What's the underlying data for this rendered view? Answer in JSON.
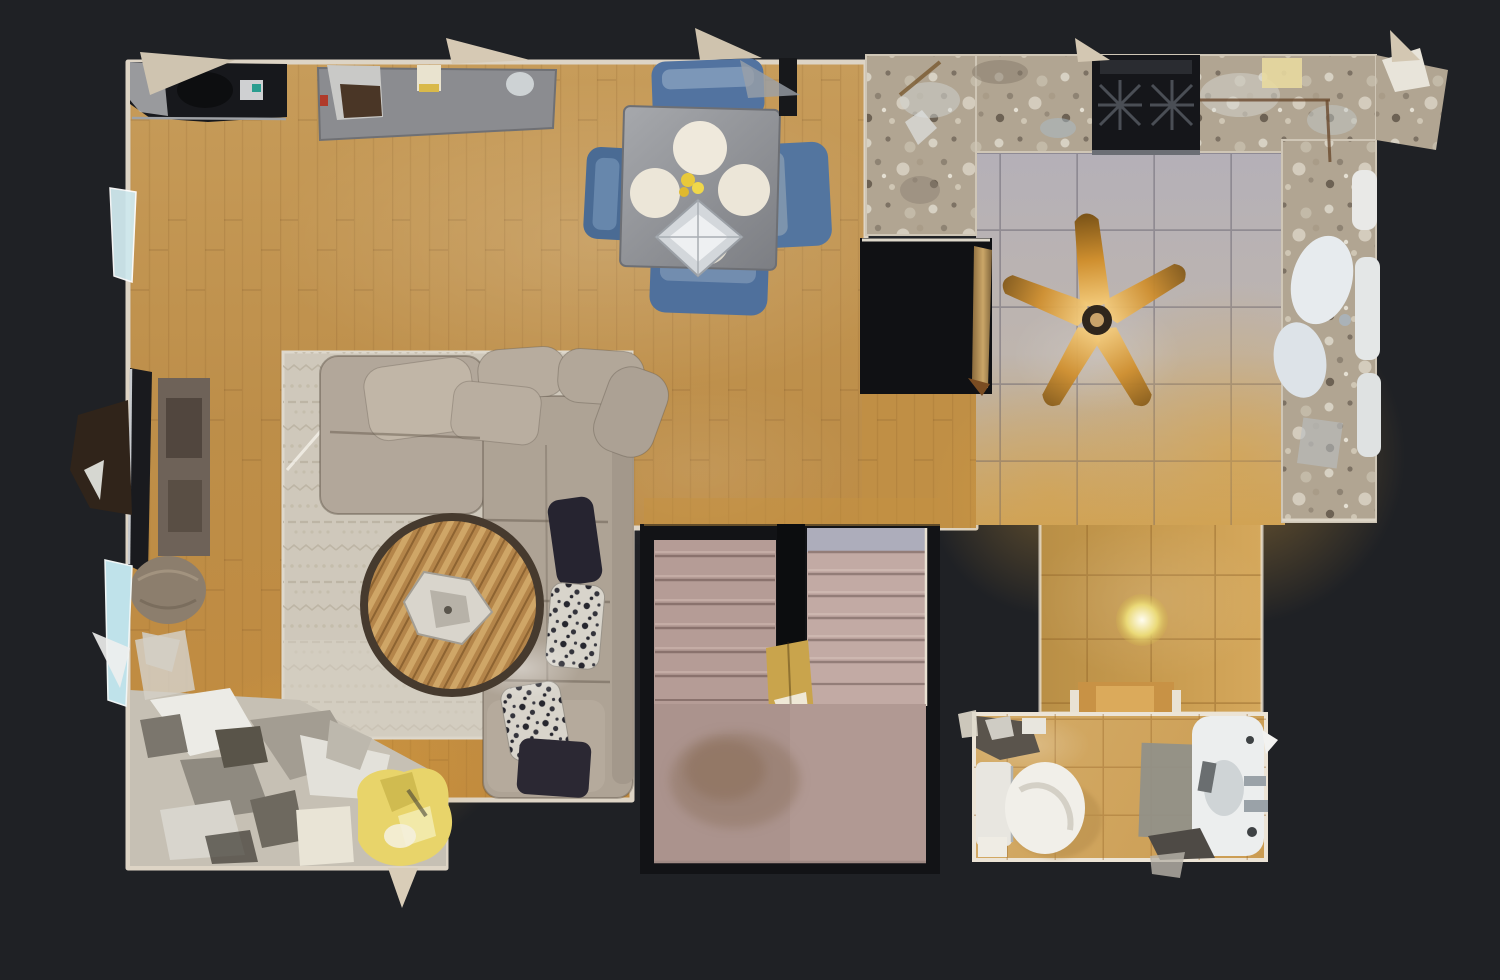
{
  "view": {
    "type": "3d-scan-floorplan-top-down",
    "description": "Top-down dollhouse floor plan view of a residential main level on a dark backdrop"
  },
  "palette": {
    "background": "#1f2125",
    "hole_black": "#101114",
    "wall": "#ddd4c5",
    "wood_floor_top": "#c79c5a",
    "wood_floor_mid": "#bd8e49",
    "wood_floor_bottom": "#c28a3c",
    "wood_patch": "#c08f45",
    "kitchen_tile": "#b4b0b8",
    "kitchen_tile_gold": "#cda35c",
    "hallway_tile": "#c79a4e",
    "granite": "#b1a592",
    "granite_light": "#d8d2c6",
    "cooktop": "#15161a",
    "fan_blade_dark": "#7d5518",
    "fan_blade": "#cf8f2f",
    "fan_blade_light": "#f2c979",
    "fan_hub": "#2f261c",
    "pendant": "#ead977",
    "rug": "#cfc8bb",
    "rug_pattern": "#b9b0a0",
    "sofa": "#b2a79a",
    "sofa_dark": "#aea395",
    "sofa_shadow": "#a2978a",
    "pillow_dark": "#262430",
    "coffee_table_rim": "#463a2e",
    "coffee_table_wood": "#b4854a",
    "dining_table": "#909297",
    "dining_chair": "#5273a0",
    "plate": "#ece6d8",
    "chandelier": "#d3d7db",
    "flowers": "#e9c93a",
    "tv": "#191a1e",
    "media_console": "#6e6258",
    "pouf": "#8c7e6d",
    "clutter": "#c6c0b4",
    "clutter_bright": "#ecebe6",
    "chair_yellow": "#e8d46a",
    "teal_fragment": "#cfe9ee",
    "stairs_carpet": "#b59c96",
    "stairs_carpet_light": "#c2aaa4",
    "stairs_landing": "#ab938d",
    "stair_gap": "#0c0d0f",
    "newel_wood": "#c9a44c",
    "bathroom_tile": "#cb9c52",
    "fixture_white": "#f1efe9",
    "bath_mat": "#90908a",
    "seam_white": "#f5f2ea"
  },
  "rooms": [
    {
      "id": "living-room",
      "label": "living room with sectional sofa, rug and coffee table"
    },
    {
      "id": "dining-area",
      "label": "dining area with square table and four blue chairs"
    },
    {
      "id": "kitchen",
      "label": "kitchen with granite counters, cooktop, island and ceiling fan"
    },
    {
      "id": "hallway",
      "label": "tiled hallway with pendant light"
    },
    {
      "id": "stairwell",
      "label": "double-flight carpeted staircase with landing"
    },
    {
      "id": "bathroom",
      "label": "bathroom with toilet, vanity and bath mat"
    }
  ],
  "objects": [
    "desk",
    "office-chair",
    "console-table",
    "dining-table",
    "dining-chairs",
    "chandelier",
    "place-settings",
    "sectional-sofa",
    "throw-pillows",
    "area-rug",
    "round-coffee-table",
    "tv",
    "media-console",
    "ottoman-pouf",
    "floor-clutter",
    "yellow-chair",
    "gas-cooktop",
    "kitchen-island-opening",
    "ceiling-fan",
    "kitchen-sink",
    "pendant-light",
    "stair-flight-left",
    "stair-flight-right",
    "stair-newel",
    "toilet",
    "bathroom-vanity",
    "bath-mat"
  ]
}
